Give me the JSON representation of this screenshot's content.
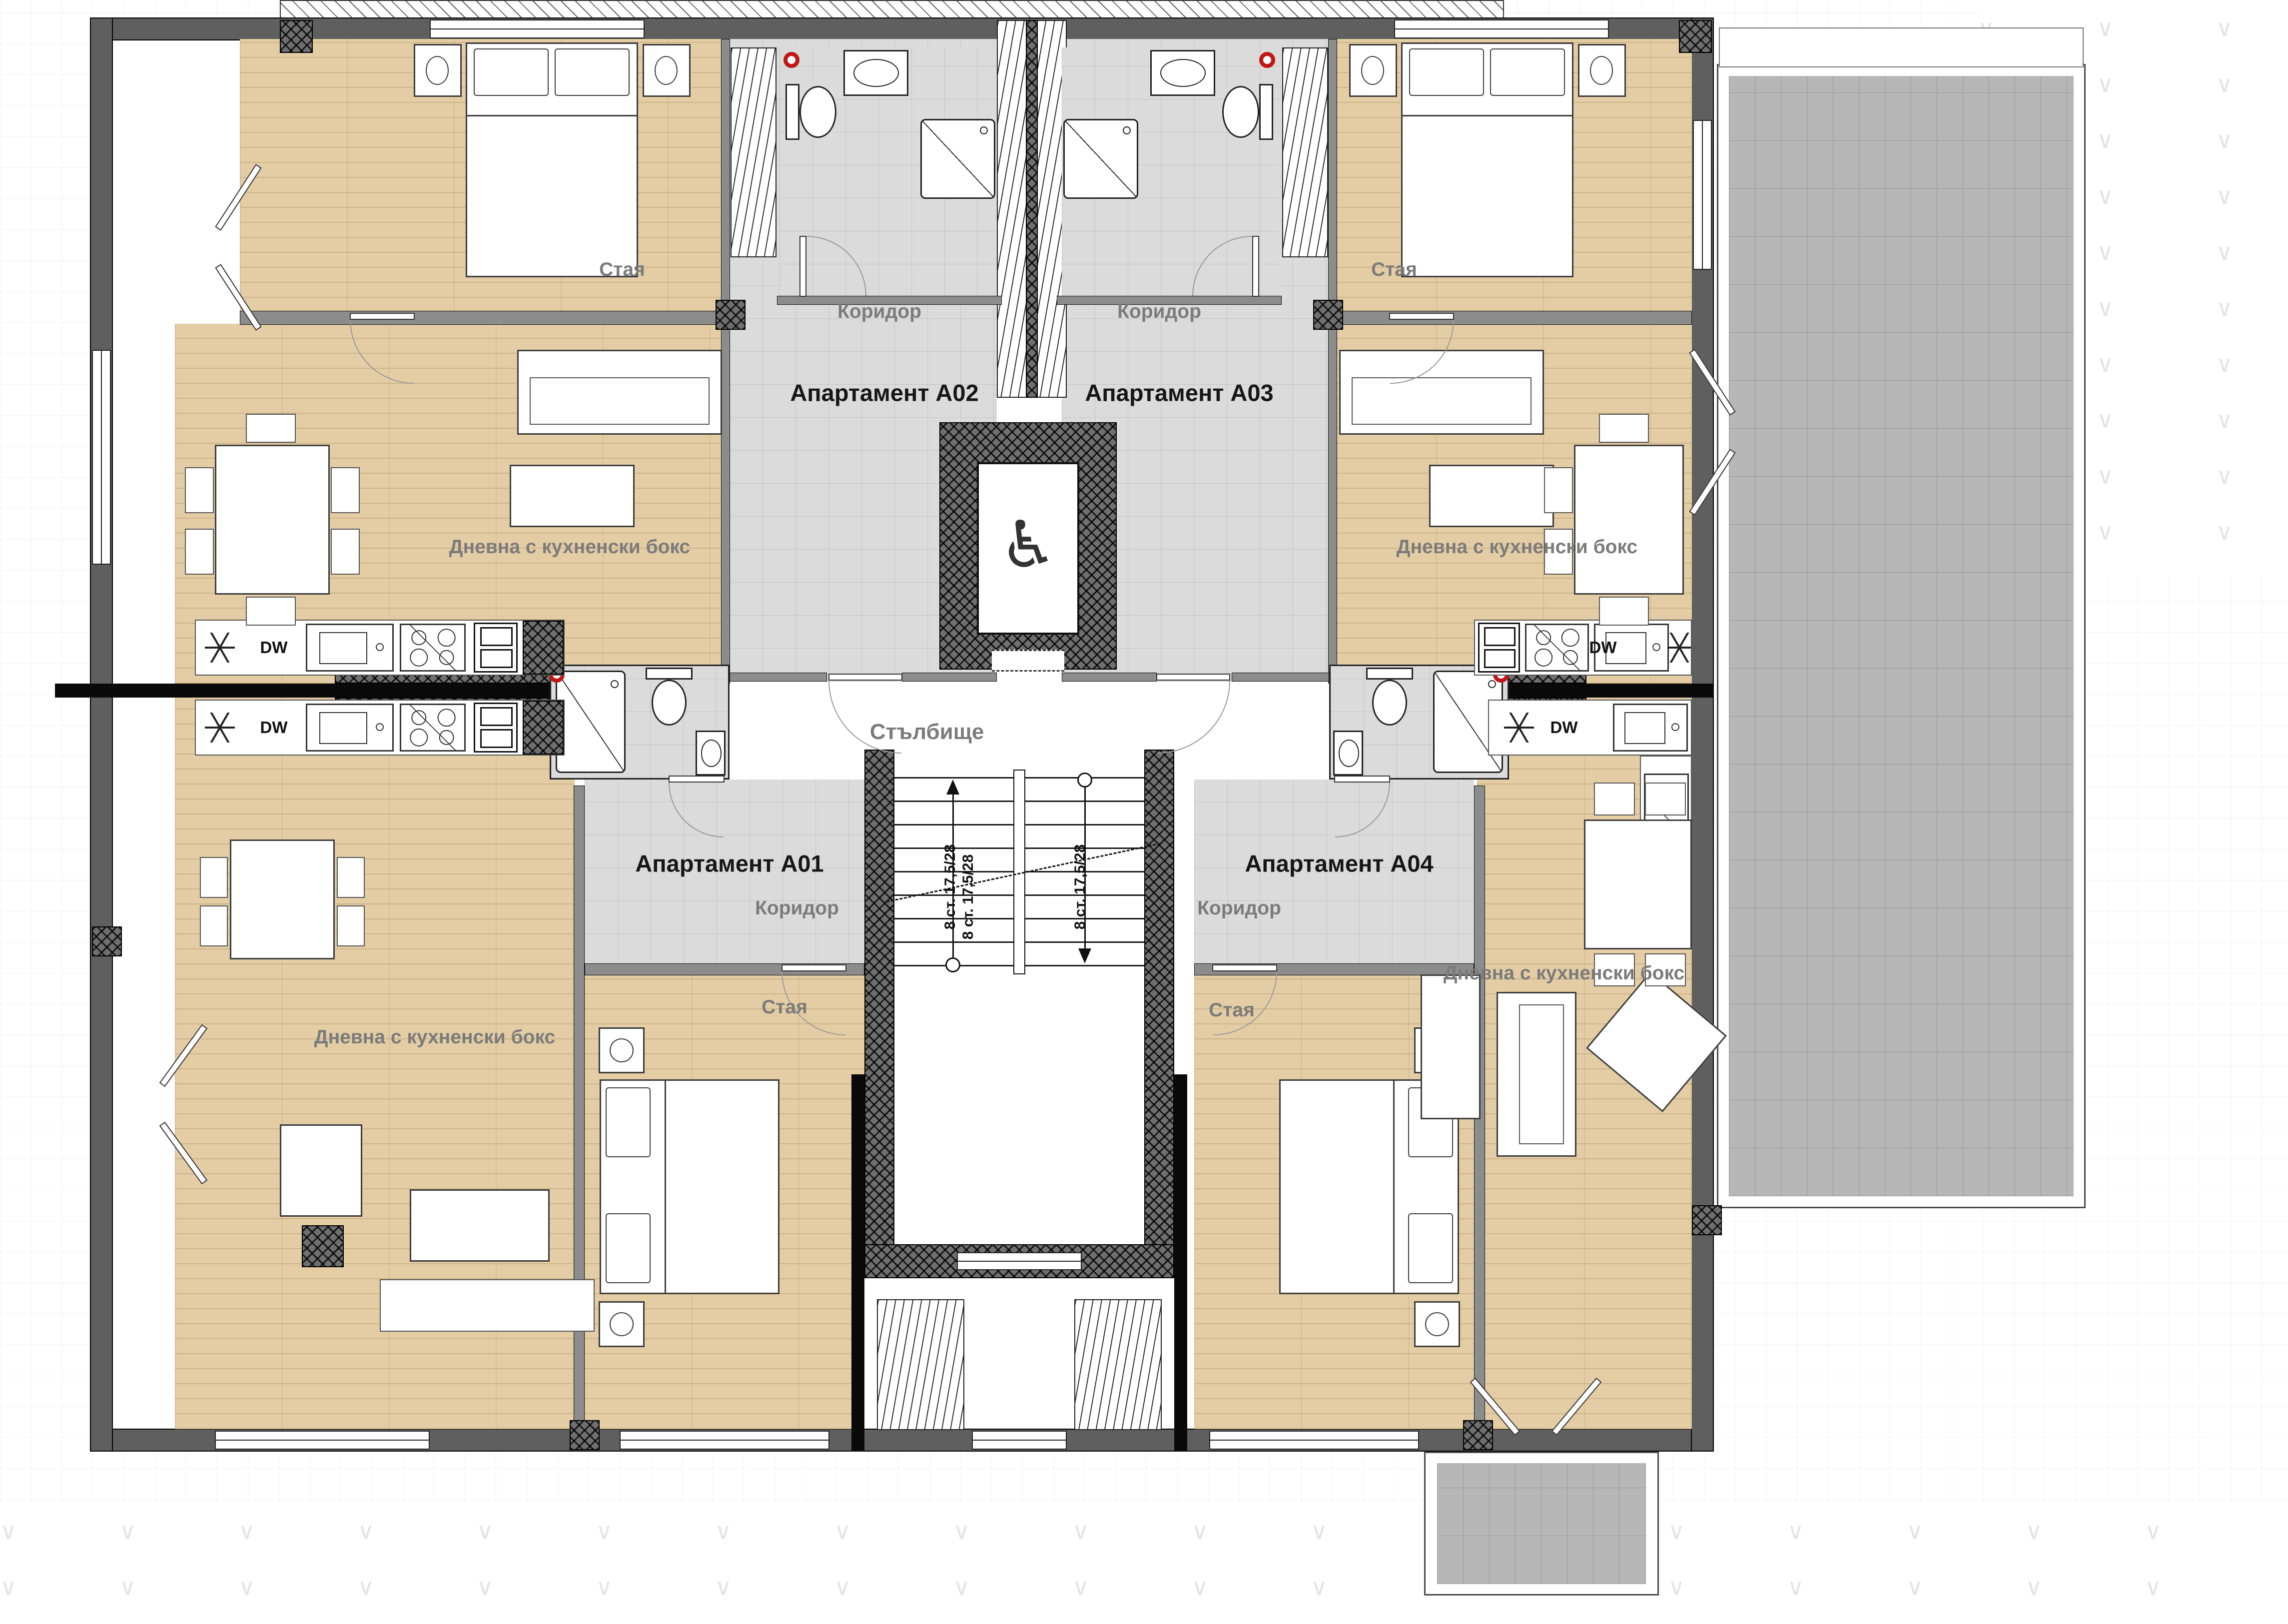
{
  "apartments": [
    {
      "id": "A01",
      "label": "Апартамент А01"
    },
    {
      "id": "A02",
      "label": "Апартамент А02"
    },
    {
      "id": "A03",
      "label": "Апартамент А03"
    },
    {
      "id": "A04",
      "label": "Апартамент А04"
    }
  ],
  "room_labels": {
    "corridor": "Коридор",
    "room": "Стая",
    "living": "Дневна с кухненски бокс",
    "staircase": "Стълбище"
  },
  "annotations": {
    "stair_flight": "8 ст. 17,5/28",
    "dishwasher": "DW",
    "accessible_elevator_icon": "♿"
  },
  "colors": {
    "wood_floor": "#e4cda4",
    "corridor_tile": "#dbdbdb",
    "terrace_tile": "#b7b7b8",
    "wall_gray": "#8c8c8c",
    "exterior_wall": "#5f5f5f",
    "party_wall_black": "#0a0a0a",
    "vent_marker_red": "#c01818"
  }
}
